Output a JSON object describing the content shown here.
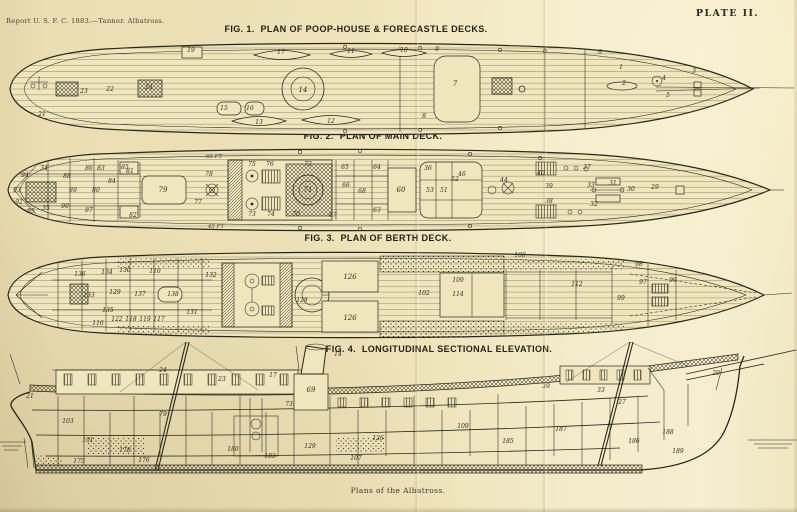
{
  "header": {
    "report_line": "Report U. S. F. C. 1883.—Tanner.  Albatross.",
    "plate_label": "PLATE II."
  },
  "caption": "Plans of the Albatross.",
  "colors": {
    "paper": "#ece1b6",
    "paper_light": "#f5eecf",
    "ink": "#2b261c"
  },
  "figures": [
    {
      "id": "fig1",
      "title": "FIG. 1.  PLAN OF POOP-HOUSE & FORECASTLE DECKS.",
      "labels": [
        {
          "t": "19",
          "x": 191,
          "y": 12
        },
        {
          "t": "17",
          "x": 281,
          "y": 14
        },
        {
          "t": "11",
          "x": 351,
          "y": 13
        },
        {
          "t": "10",
          "x": 404,
          "y": 12
        },
        {
          "t": "9",
          "x": 437,
          "y": 11
        },
        {
          "t": "23",
          "x": 84,
          "y": 53
        },
        {
          "t": "22",
          "x": 110,
          "y": 51
        },
        {
          "t": "24",
          "x": 149,
          "y": 49
        },
        {
          "t": "21",
          "x": 42,
          "y": 76
        },
        {
          "t": "14",
          "x": 303,
          "y": 52,
          "s": 7
        },
        {
          "t": "15",
          "x": 224,
          "y": 70
        },
        {
          "t": "16",
          "x": 250,
          "y": 70
        },
        {
          "t": "13",
          "x": 259,
          "y": 84
        },
        {
          "t": "12",
          "x": 331,
          "y": 83
        },
        {
          "t": "7",
          "x": 455,
          "y": 46,
          "s": 7
        },
        {
          "t": "8",
          "x": 424,
          "y": 78
        },
        {
          "t": "1",
          "x": 621,
          "y": 29
        },
        {
          "t": "2",
          "x": 624,
          "y": 45
        },
        {
          "t": "4",
          "x": 664,
          "y": 40
        },
        {
          "t": "3",
          "x": 694,
          "y": 33
        },
        {
          "t": "5",
          "x": 668,
          "y": 57
        },
        {
          "t": "6",
          "x": 600,
          "y": 14
        }
      ]
    },
    {
      "id": "fig2",
      "title": "FIG. 2.  PLAN OF MAIN DECK.",
      "annotations": [
        {
          "t": "65 FT",
          "x": 214,
          "y": 12
        },
        {
          "t": "45 FT",
          "x": 216,
          "y": 82
        }
      ],
      "labels": [
        {
          "t": "94",
          "x": 25,
          "y": 31
        },
        {
          "t": "93",
          "x": 17,
          "y": 46
        },
        {
          "t": "92",
          "x": 19,
          "y": 58
        },
        {
          "t": "95",
          "x": 31,
          "y": 67
        },
        {
          "t": "34",
          "x": 44,
          "y": 24
        },
        {
          "t": "35",
          "x": 46,
          "y": 64
        },
        {
          "t": "88",
          "x": 67,
          "y": 32
        },
        {
          "t": "89",
          "x": 73,
          "y": 46
        },
        {
          "t": "90",
          "x": 65,
          "y": 62
        },
        {
          "t": "86",
          "x": 89,
          "y": 24
        },
        {
          "t": "87",
          "x": 89,
          "y": 66
        },
        {
          "t": "83",
          "x": 101,
          "y": 24
        },
        {
          "t": "84",
          "x": 112,
          "y": 37
        },
        {
          "t": "85",
          "x": 125,
          "y": 23
        },
        {
          "t": "81",
          "x": 130,
          "y": 27
        },
        {
          "t": "82",
          "x": 133,
          "y": 71
        },
        {
          "t": "80",
          "x": 96,
          "y": 46
        },
        {
          "t": "79",
          "x": 163,
          "y": 46,
          "s": 7
        },
        {
          "t": "78",
          "x": 209,
          "y": 30
        },
        {
          "t": "77",
          "x": 198,
          "y": 58
        },
        {
          "t": "75",
          "x": 252,
          "y": 20
        },
        {
          "t": "76",
          "x": 270,
          "y": 20
        },
        {
          "t": "74",
          "x": 271,
          "y": 70
        },
        {
          "t": "73",
          "x": 252,
          "y": 70
        },
        {
          "t": "70",
          "x": 296,
          "y": 70
        },
        {
          "t": "72",
          "x": 308,
          "y": 20
        },
        {
          "t": "71",
          "x": 308,
          "y": 46,
          "s": 7
        },
        {
          "t": "65",
          "x": 345,
          "y": 23
        },
        {
          "t": "66",
          "x": 346,
          "y": 41
        },
        {
          "t": "67",
          "x": 333,
          "y": 71
        },
        {
          "t": "68",
          "x": 362,
          "y": 47
        },
        {
          "t": "64",
          "x": 377,
          "y": 23
        },
        {
          "t": "63",
          "x": 377,
          "y": 66
        },
        {
          "t": "60",
          "x": 401,
          "y": 46,
          "s": 7
        },
        {
          "t": "36",
          "x": 428,
          "y": 24
        },
        {
          "t": "46",
          "x": 462,
          "y": 30
        },
        {
          "t": "53",
          "x": 430,
          "y": 46
        },
        {
          "t": "51",
          "x": 444,
          "y": 46
        },
        {
          "t": "52",
          "x": 455,
          "y": 35
        },
        {
          "t": "44",
          "x": 504,
          "y": 36
        },
        {
          "t": "40",
          "x": 541,
          "y": 29
        },
        {
          "t": "39",
          "x": 549,
          "y": 42
        },
        {
          "t": "38",
          "x": 549,
          "y": 57
        },
        {
          "t": "37",
          "x": 587,
          "y": 23
        },
        {
          "t": "33",
          "x": 591,
          "y": 41
        },
        {
          "t": "32",
          "x": 594,
          "y": 60
        },
        {
          "t": "31",
          "x": 613,
          "y": 39
        },
        {
          "t": "30",
          "x": 631,
          "y": 45
        },
        {
          "t": "29",
          "x": 655,
          "y": 43
        }
      ]
    },
    {
      "id": "fig3",
      "title": "FIG. 3.  PLAN OF BERTH DECK.",
      "labels": [
        {
          "t": "136",
          "x": 80,
          "y": 28
        },
        {
          "t": "134",
          "x": 107,
          "y": 26
        },
        {
          "t": "130",
          "x": 125,
          "y": 24
        },
        {
          "t": "110",
          "x": 155,
          "y": 25
        },
        {
          "t": "133",
          "x": 89,
          "y": 49
        },
        {
          "t": "129",
          "x": 115,
          "y": 46
        },
        {
          "t": "137",
          "x": 140,
          "y": 48
        },
        {
          "t": "135",
          "x": 108,
          "y": 64
        },
        {
          "t": "138",
          "x": 173,
          "y": 48
        },
        {
          "t": "132",
          "x": 211,
          "y": 29
        },
        {
          "t": "131",
          "x": 192,
          "y": 66
        },
        {
          "t": "128",
          "x": 302,
          "y": 54
        },
        {
          "t": "126",
          "x": 350,
          "y": 31,
          "s": 7
        },
        {
          "t": "126",
          "x": 350,
          "y": 72,
          "s": 7
        },
        {
          "t": "122",
          "x": 117,
          "y": 73
        },
        {
          "t": "118",
          "x": 131,
          "y": 73
        },
        {
          "t": "119",
          "x": 145,
          "y": 73
        },
        {
          "t": "117",
          "x": 159,
          "y": 73
        },
        {
          "t": "116",
          "x": 98,
          "y": 77
        },
        {
          "t": "109",
          "x": 458,
          "y": 34
        },
        {
          "t": "114",
          "x": 458,
          "y": 48
        },
        {
          "t": "112",
          "x": 577,
          "y": 38
        },
        {
          "t": "108",
          "x": 520,
          "y": 9
        },
        {
          "t": "102",
          "x": 424,
          "y": 47
        },
        {
          "t": "98",
          "x": 639,
          "y": 18
        },
        {
          "t": "97",
          "x": 643,
          "y": 36
        },
        {
          "t": "96",
          "x": 673,
          "y": 34
        },
        {
          "t": "99",
          "x": 621,
          "y": 52
        }
      ]
    },
    {
      "id": "fig4",
      "title": "FIG. 4.  LONGITUDINAL SECTIONAL ELEVATION.",
      "labels": [
        {
          "t": "24",
          "x": 163,
          "y": 32
        },
        {
          "t": "23",
          "x": 222,
          "y": 41
        },
        {
          "t": "17",
          "x": 273,
          "y": 37
        },
        {
          "t": "14",
          "x": 338,
          "y": 16
        },
        {
          "t": "21",
          "x": 30,
          "y": 58
        },
        {
          "t": "69",
          "x": 311,
          "y": 52,
          "s": 7
        },
        {
          "t": "73",
          "x": 289,
          "y": 66
        },
        {
          "t": "79",
          "x": 163,
          "y": 76
        },
        {
          "t": "103",
          "x": 68,
          "y": 83
        },
        {
          "t": "101",
          "x": 88,
          "y": 102
        },
        {
          "t": "178",
          "x": 125,
          "y": 112
        },
        {
          "t": "175",
          "x": 79,
          "y": 123
        },
        {
          "t": "176",
          "x": 144,
          "y": 122
        },
        {
          "t": "180",
          "x": 233,
          "y": 111
        },
        {
          "t": "183",
          "x": 270,
          "y": 118
        },
        {
          "t": "129",
          "x": 310,
          "y": 108
        },
        {
          "t": "126",
          "x": 378,
          "y": 100
        },
        {
          "t": "107",
          "x": 356,
          "y": 120
        },
        {
          "t": "27",
          "x": 622,
          "y": 64
        },
        {
          "t": "33",
          "x": 601,
          "y": 52
        },
        {
          "t": "39",
          "x": 546,
          "y": 48
        },
        {
          "t": "29",
          "x": 716,
          "y": 35
        },
        {
          "t": "185",
          "x": 508,
          "y": 103
        },
        {
          "t": "187",
          "x": 561,
          "y": 91
        },
        {
          "t": "186",
          "x": 634,
          "y": 103
        },
        {
          "t": "189",
          "x": 678,
          "y": 113
        },
        {
          "t": "188",
          "x": 668,
          "y": 94
        },
        {
          "t": "109",
          "x": 463,
          "y": 88
        }
      ]
    }
  ]
}
